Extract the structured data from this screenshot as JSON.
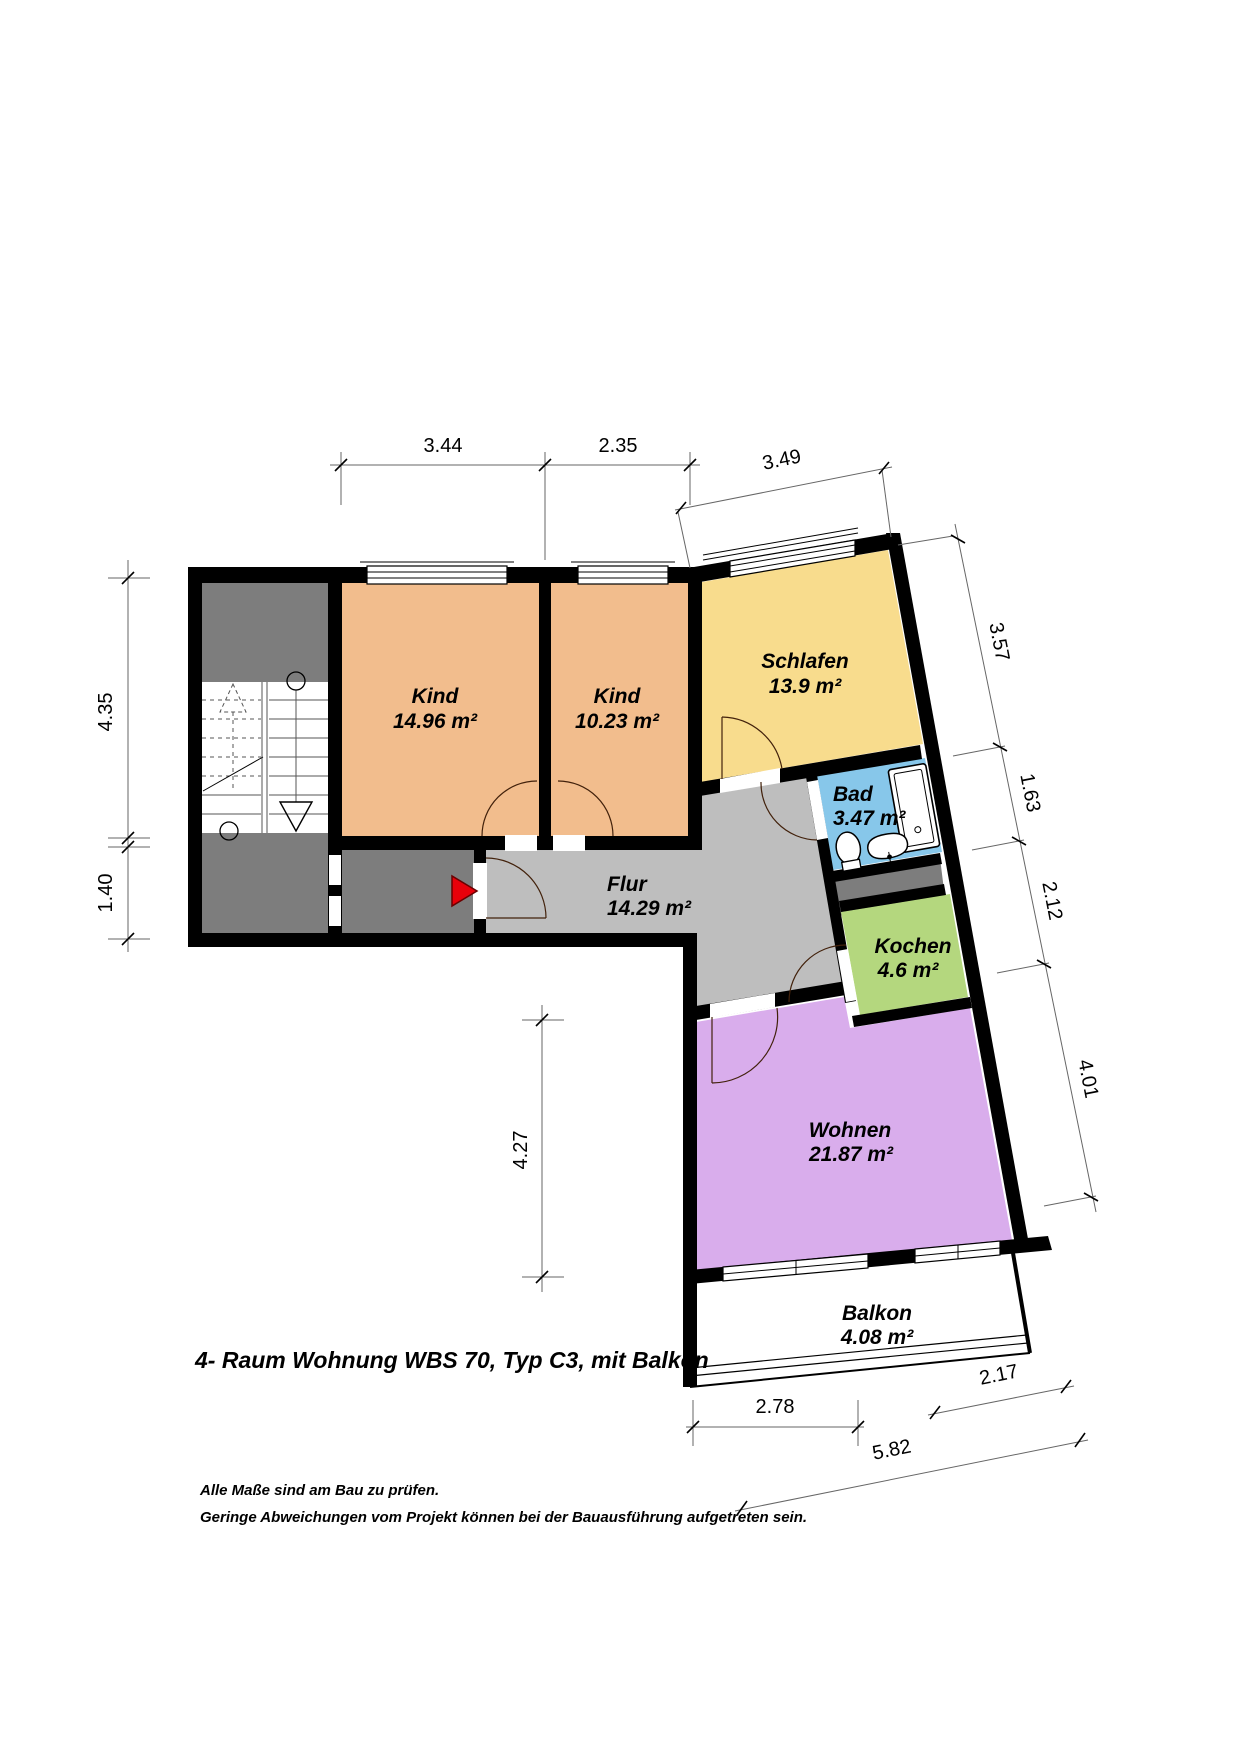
{
  "title": "4- Raum Wohnung WBS 70, Typ C3, mit Balkon",
  "notes": [
    "Alle Maße sind am Bau zu prüfen.",
    "Geringe Abweichungen vom Projekt können bei der Bauausführung aufgetreten sein."
  ],
  "rooms": [
    {
      "name": "Kind",
      "area": "14.96 m²",
      "color": "#F2BD8D"
    },
    {
      "name": "Kind",
      "area": "10.23 m²",
      "color": "#F2BD8D"
    },
    {
      "name": "Schlafen",
      "area": "13.9 m²",
      "color": "#F8DC8D"
    },
    {
      "name": "Bad",
      "area": "3.47 m²",
      "color": "#87C7EA"
    },
    {
      "name": "Flur",
      "area": "14.29 m²",
      "color": "#BEBEBE"
    },
    {
      "name": "Kochen",
      "area": "4.6 m²",
      "color": "#B4D77E"
    },
    {
      "name": "Wohnen",
      "area": "21.87 m²",
      "color": "#D9ADEC"
    },
    {
      "name": "Balkon",
      "area": "4.08 m²",
      "color": "#FFFFFF"
    }
  ],
  "dimensions": {
    "top": [
      "3.44",
      "2.35",
      "3.49"
    ],
    "left": [
      "4.35",
      "1.40"
    ],
    "right": [
      "3.57",
      "1.63",
      "2.12",
      "4.01"
    ],
    "inner": [
      "4.27"
    ],
    "bottom": [
      "2.78",
      "2.17",
      "5.82"
    ]
  },
  "colors": {
    "wall": "#000000",
    "stair_gray": "#7D7D7D",
    "flur_gray": "#BEBEBE",
    "entrance_arrow": "#E8000A"
  }
}
